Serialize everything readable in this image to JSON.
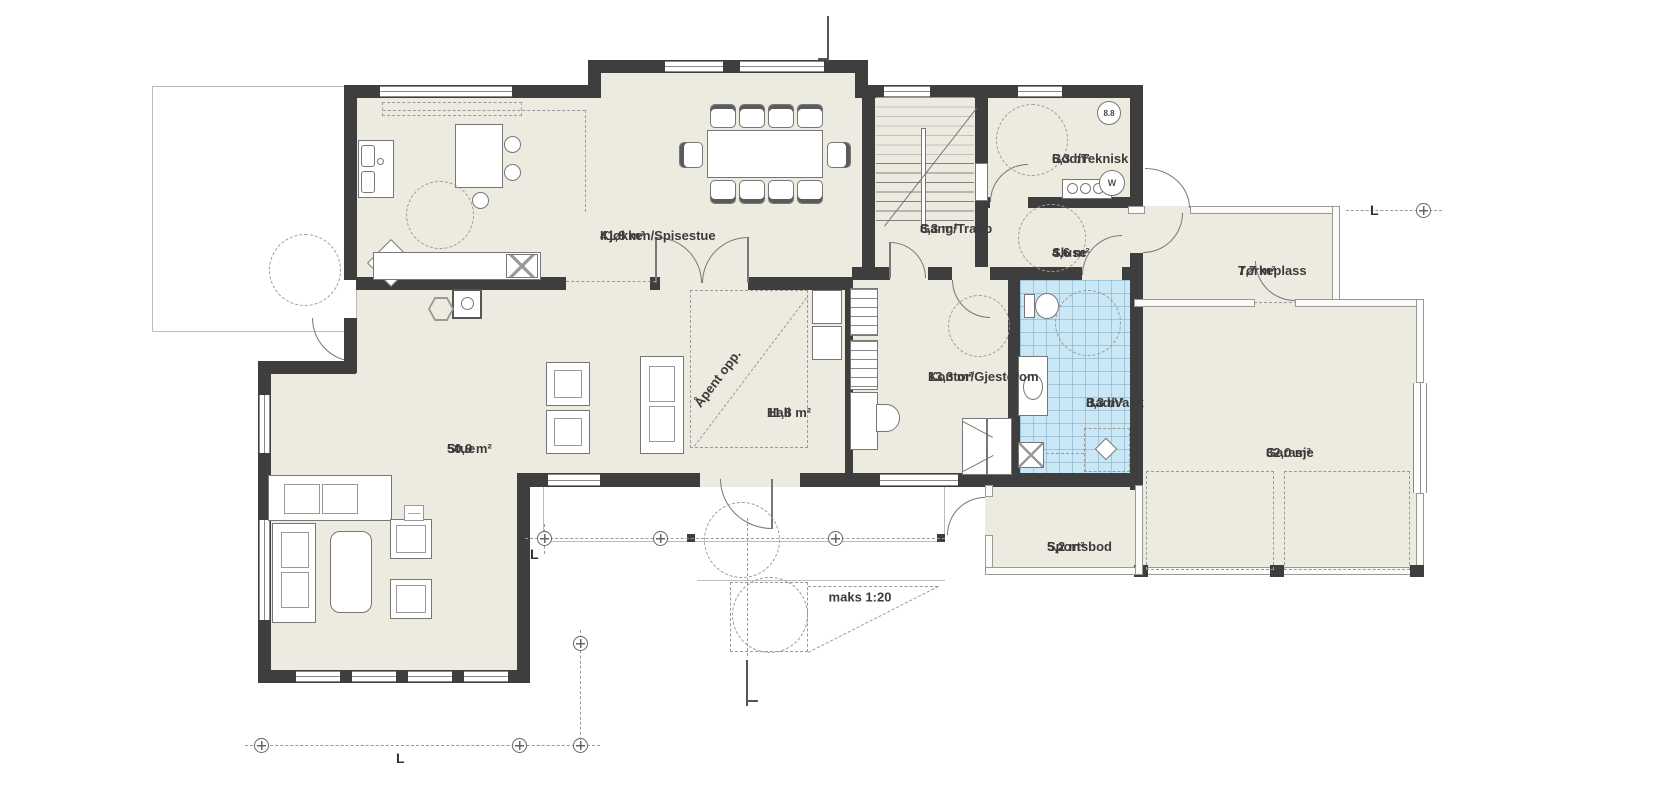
{
  "rooms": [
    {
      "name": "Kjøkken/Spisestue",
      "area": "41,8 m²"
    },
    {
      "name": "Gang/Trapp",
      "area": "8,3 m²"
    },
    {
      "name": "Bod/Teknisk",
      "area": "6,3 m²"
    },
    {
      "name": "Sluse",
      "area": "4,6 m²"
    },
    {
      "name": "Tørkeplass",
      "area": "7,7 m²"
    },
    {
      "name": "Hall",
      "area": "11,8 m²"
    },
    {
      "name": "Kontor/Gjesterom",
      "area": "13,3 m²"
    },
    {
      "name": "Bad/Vask",
      "area": "8,3 m²"
    },
    {
      "name": "Garasje",
      "area": "32,0 m²"
    },
    {
      "name": "Stue",
      "area": "50,9 m²"
    },
    {
      "name": "Sportsbod",
      "area": "5,2 m²"
    }
  ],
  "annotations": {
    "open_above": "Åpent opp.",
    "ramp_note": "maks 1:20",
    "grid_letter": "L",
    "corner_badge": "8.8",
    "appliance_letter": "W"
  },
  "colors": {
    "floor": "#edeae0",
    "wall": "#3e3e3e",
    "wet_room_tile": "#c9e7f4",
    "dashed_lines": "#9a9a9a"
  }
}
